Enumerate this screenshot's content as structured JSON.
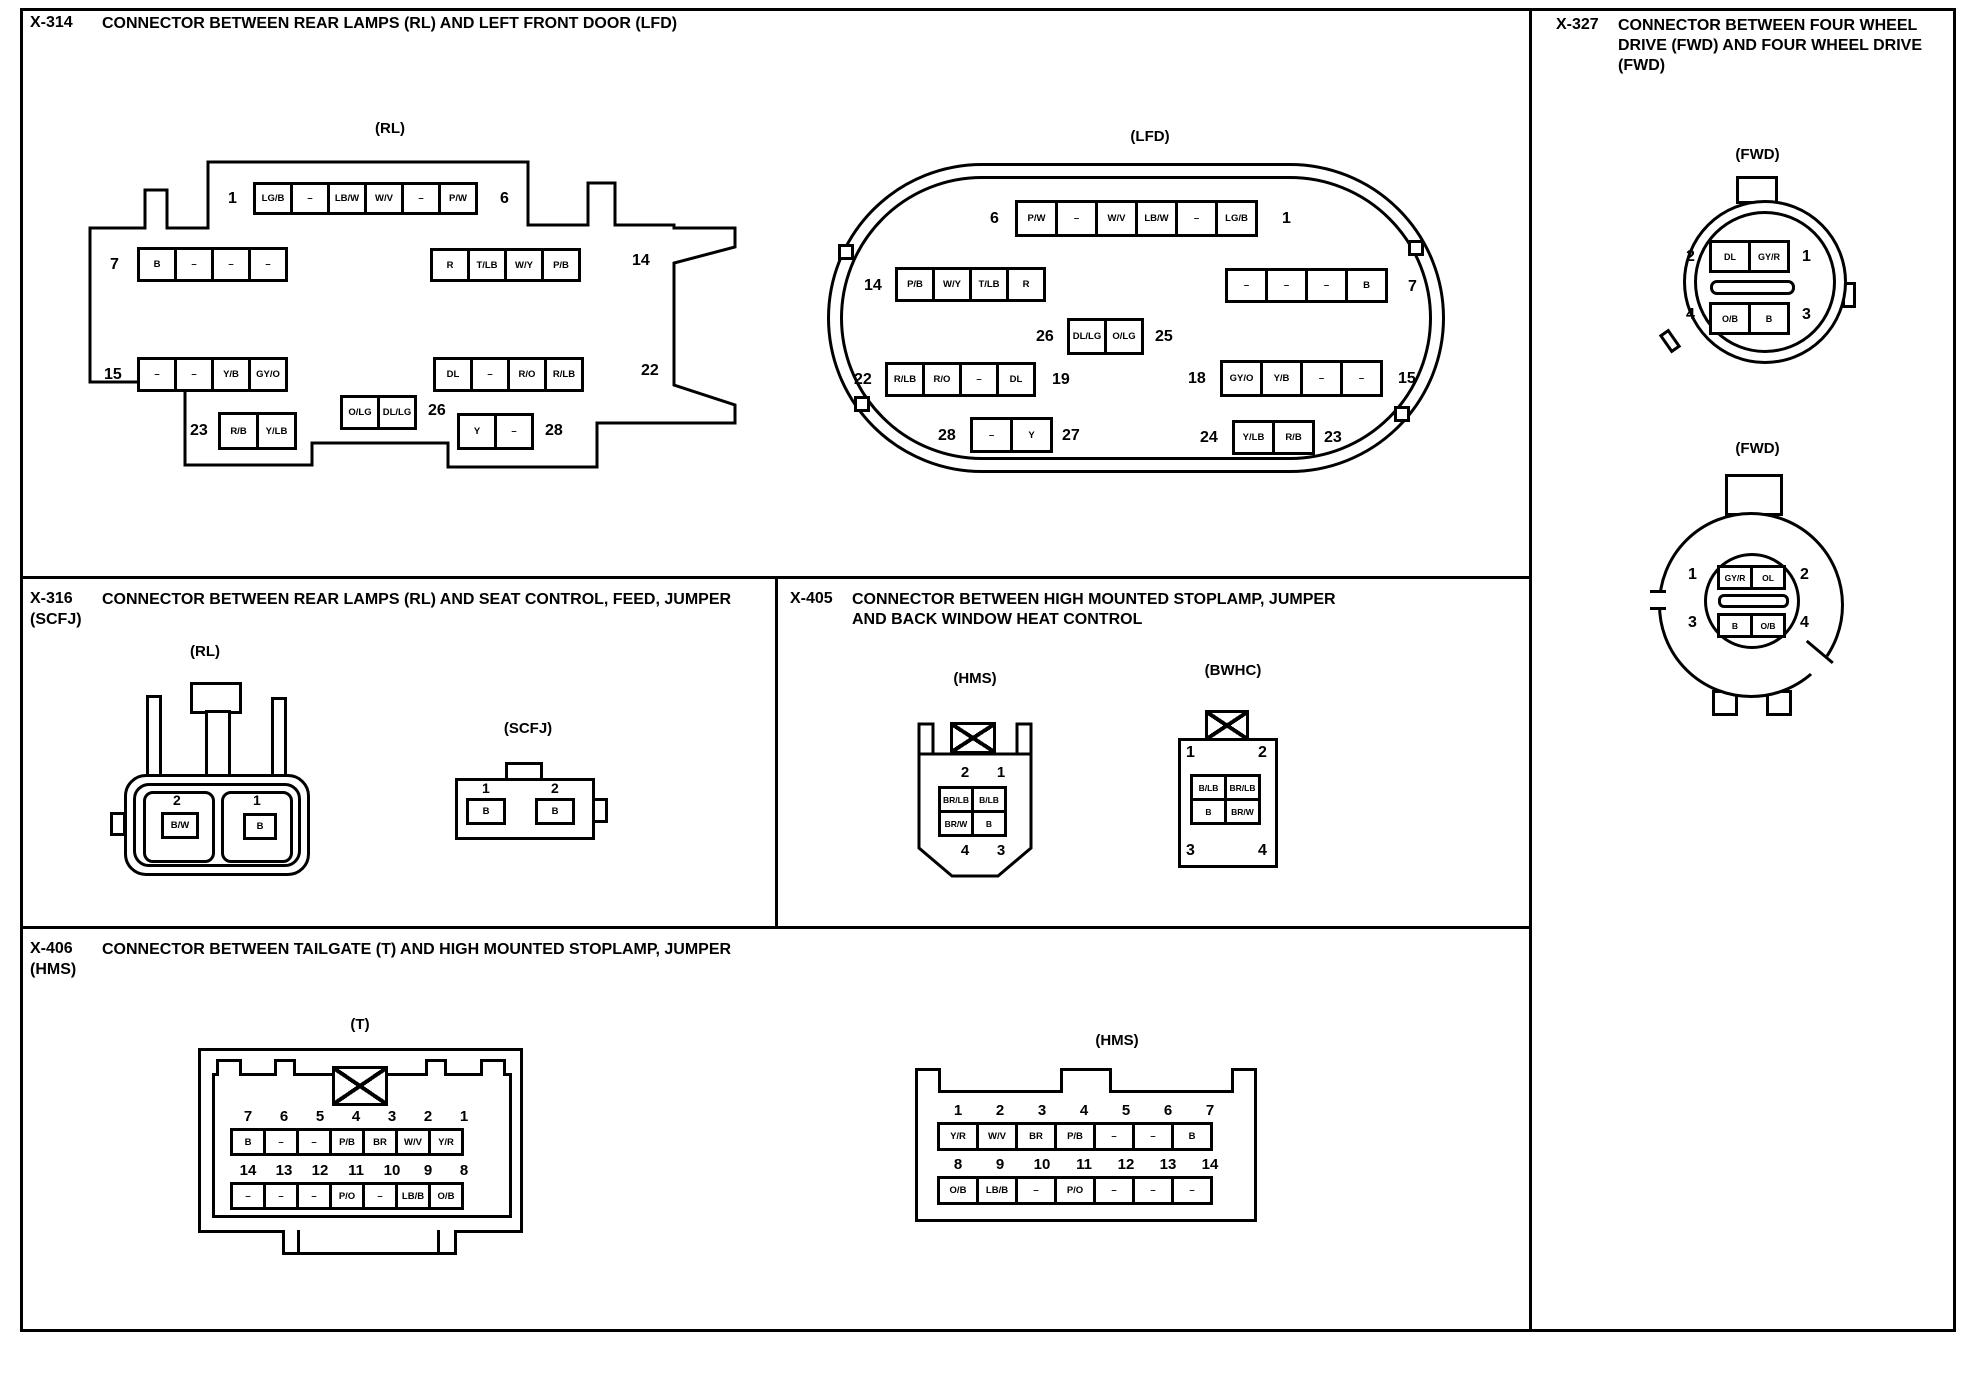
{
  "sections": {
    "x314": {
      "code": "X-314",
      "title": "CONNECTOR BETWEEN REAR LAMPS (RL) AND LEFT FRONT DOOR (LFD)",
      "rl": {
        "label": "(RL)",
        "row1": {
          "ln": "1",
          "cells": [
            "LG/B",
            "–",
            "LB/W",
            "W/V",
            "–",
            "P/W"
          ],
          "rn": "6"
        },
        "row2l": {
          "ln": "7",
          "cells": [
            "B",
            "–",
            "–",
            "–"
          ]
        },
        "row2r": {
          "cells": [
            "R",
            "T/LB",
            "W/Y",
            "P/B"
          ],
          "rn": "14"
        },
        "row3l": {
          "ln": "15",
          "cells": [
            "–",
            "–",
            "Y/B",
            "GY/O"
          ]
        },
        "row3r": {
          "cells": [
            "DL",
            "–",
            "R/O",
            "R/LB"
          ],
          "rn": "22"
        },
        "row4l": {
          "ln": "23",
          "cells": [
            "R/B",
            "Y/LB"
          ]
        },
        "row4c": {
          "cells": [
            "O/LG",
            "DL/LG"
          ],
          "rn": "26"
        },
        "row4r": {
          "cells": [
            "Y",
            "–"
          ],
          "rn": "28"
        }
      },
      "lfd": {
        "label": "(LFD)",
        "row1": {
          "ln": "6",
          "cells": [
            "P/W",
            "–",
            "W/V",
            "LB/W",
            "–",
            "LG/B"
          ],
          "rn": "1"
        },
        "row2l": {
          "ln": "14",
          "cells": [
            "P/B",
            "W/Y",
            "T/LB",
            "R"
          ]
        },
        "row2r": {
          "cells": [
            "–",
            "–",
            "–",
            "B"
          ],
          "rn": "7"
        },
        "rowc": {
          "ln": "26",
          "cells": [
            "DL/LG",
            "O/LG"
          ],
          "rn": "25"
        },
        "row3l": {
          "ln": "22",
          "cells": [
            "R/LB",
            "R/O",
            "–",
            "DL"
          ],
          "rn": "19"
        },
        "row3r": {
          "ln": "18",
          "cells": [
            "GY/O",
            "Y/B",
            "–",
            "–"
          ],
          "rn": "15"
        },
        "row4l": {
          "ln": "28",
          "cells": [
            "–",
            "Y"
          ],
          "rn": "27"
        },
        "row4r": {
          "ln": "24",
          "cells": [
            "Y/LB",
            "R/B"
          ],
          "rn": "23"
        }
      }
    },
    "x327": {
      "code": "X-327",
      "title": "CONNECTOR BETWEEN FOUR WHEEL\nDRIVE (FWD) AND FOUR WHEEL DRIVE\n(FWD)",
      "top": {
        "label": "(FWD)",
        "row1": {
          "ln": "2",
          "cells": [
            "DL",
            "GY/R"
          ],
          "rn": "1"
        },
        "row2": {
          "ln": "4",
          "cells": [
            "O/B",
            "B"
          ],
          "rn": "3"
        }
      },
      "bottom": {
        "label": "(FWD)",
        "row1": {
          "ln": "1",
          "cells": [
            "GY/R",
            "OL"
          ],
          "rn": "2"
        },
        "row2": {
          "ln": "3",
          "cells": [
            "B",
            "O/B"
          ],
          "rn": "4"
        }
      }
    },
    "x316": {
      "code": "X-316",
      "title": "CONNECTOR BETWEEN REAR LAMPS (RL) AND SEAT CONTROL, FEED, JUMPER",
      "title2": "(SCFJ)",
      "rl": {
        "label": "(RL)",
        "pins": [
          {
            "n": "2",
            "c": "B/W"
          },
          {
            "n": "1",
            "c": "B"
          }
        ]
      },
      "scfj": {
        "label": "(SCFJ)",
        "pins": [
          {
            "n": "1",
            "c": "B"
          },
          {
            "n": "2",
            "c": "B"
          }
        ]
      }
    },
    "x405": {
      "code": "X-405",
      "title": "CONNECTOR BETWEEN HIGH MOUNTED STOPLAMP, JUMPER\nAND BACK WINDOW HEAT CONTROL",
      "hms": {
        "label": "(HMS)",
        "top_nums": [
          "2",
          "1"
        ],
        "grid": [
          "BR/LB",
          "B/LB",
          "BR/W",
          "B"
        ],
        "bottom_nums": [
          "4",
          "3"
        ]
      },
      "bwhc": {
        "label": "(BWHC)",
        "tl": "1",
        "tr": "2",
        "bl": "3",
        "br": "4",
        "grid": [
          "B/LB",
          "BR/LB",
          "B",
          "BR/W"
        ]
      }
    },
    "x406": {
      "code": "X-406",
      "title": "CONNECTOR BETWEEN TAILGATE (T) AND HIGH MOUNTED STOPLAMP, JUMPER",
      "title2": "(HMS)",
      "t": {
        "label": "(T)",
        "nums1": [
          "7",
          "6",
          "5",
          "4",
          "3",
          "2",
          "1"
        ],
        "cells1": [
          "B",
          "–",
          "–",
          "P/B",
          "BR",
          "W/V",
          "Y/R"
        ],
        "nums2": [
          "14",
          "13",
          "12",
          "11",
          "10",
          "9",
          "8"
        ],
        "cells2": [
          "–",
          "–",
          "–",
          "P/O",
          "–",
          "LB/B",
          "O/B"
        ]
      },
      "hms": {
        "label": "(HMS)",
        "nums1": [
          "1",
          "2",
          "3",
          "4",
          "5",
          "6",
          "7"
        ],
        "cells1": [
          "Y/R",
          "W/V",
          "BR",
          "P/B",
          "–",
          "–",
          "B"
        ],
        "nums2": [
          "8",
          "9",
          "10",
          "11",
          "12",
          "13",
          "14"
        ],
        "cells2": [
          "O/B",
          "LB/B",
          "–",
          "P/O",
          "–",
          "–",
          "–"
        ]
      }
    }
  }
}
